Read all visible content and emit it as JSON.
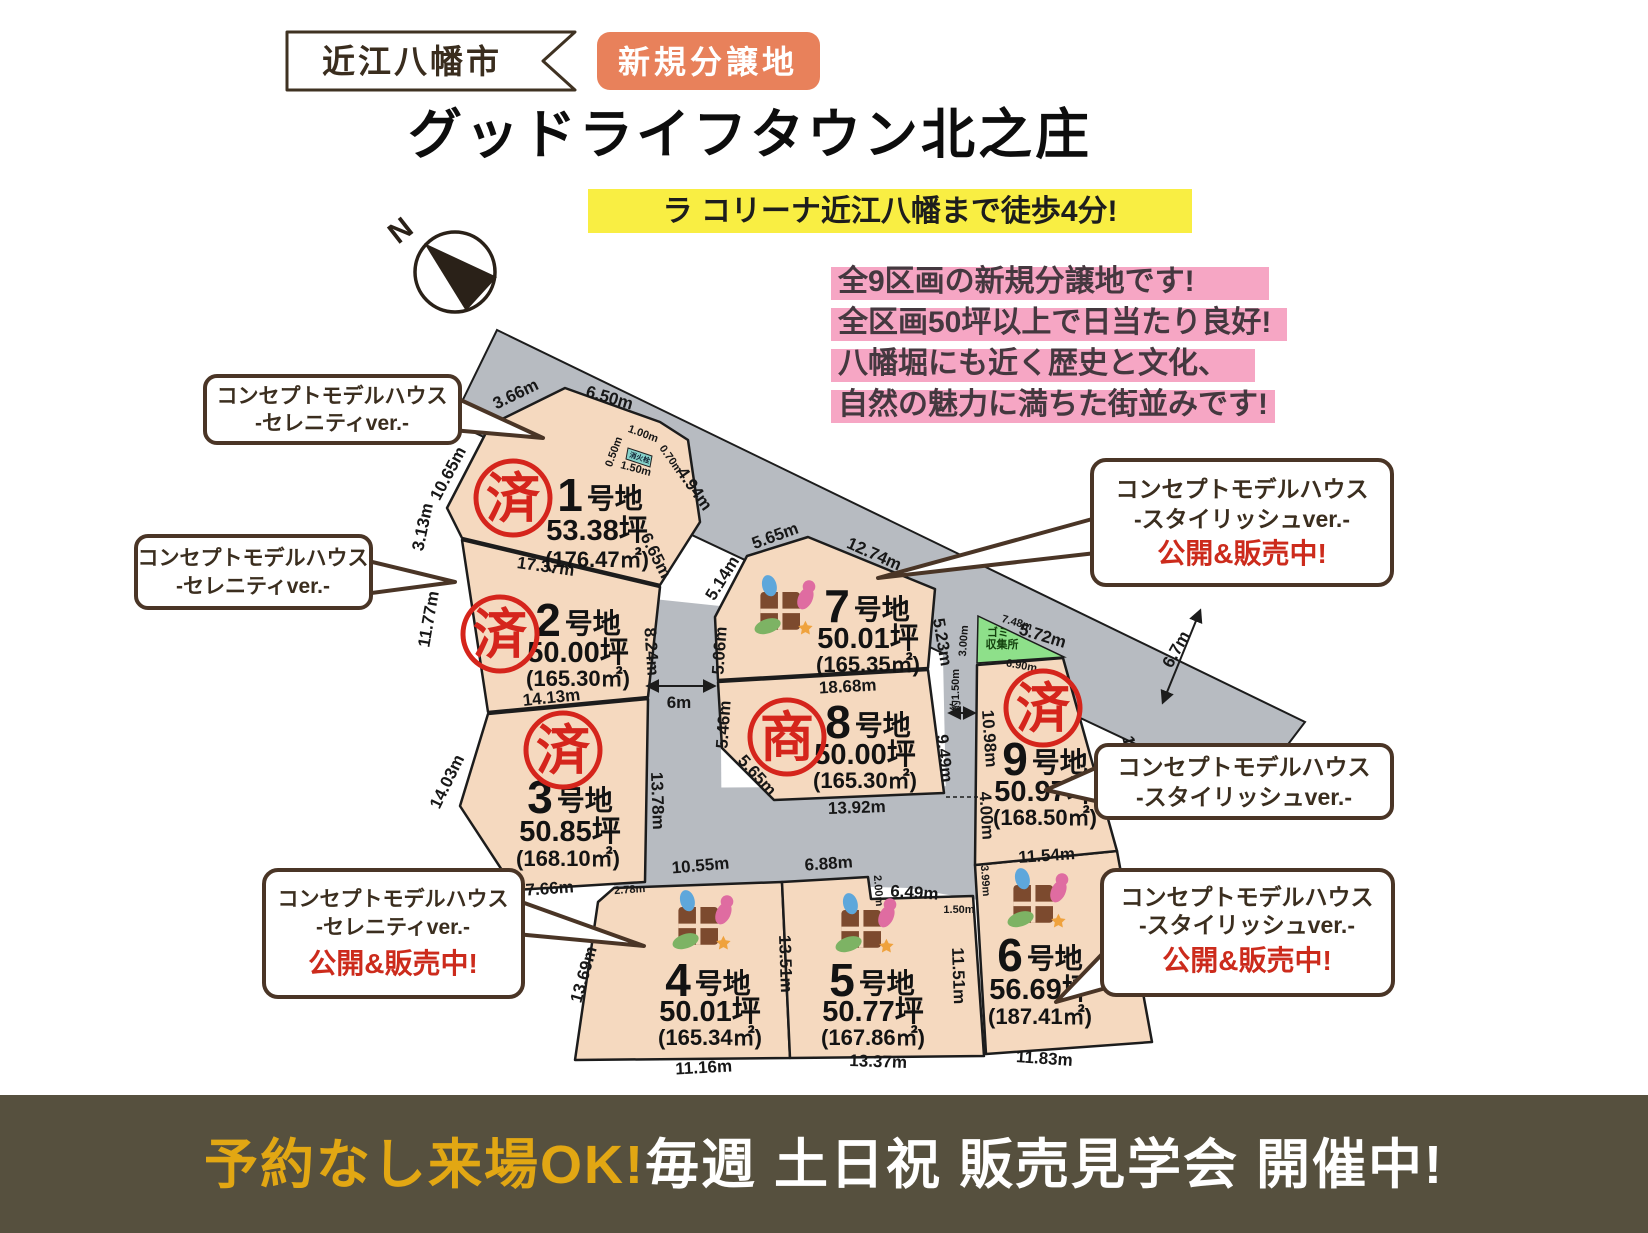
{
  "header": {
    "city_badge": "近江八幡市",
    "new_badge": "新規分譲地",
    "title": "グッドライフタウン北之庄",
    "highlight": "ラ コリーナ近江八幡まで徒歩4分!"
  },
  "features": [
    "全9区画の新規分譲地です!",
    "全区画50坪以上で日当たり良好!",
    "八幡堀にも近く歴史と文化、",
    "自然の魅力に満ちた街並みです!"
  ],
  "compass": {
    "label": "N"
  },
  "map": {
    "plot_suffix": "号地",
    "garbage_label1": "ゴミ",
    "garbage_label2": "収集所",
    "hydrant_label": "消火栓",
    "plots": [
      {
        "no": "1",
        "tsubo": "53.38坪",
        "sqm": "(176.47㎡)",
        "stamp": "済"
      },
      {
        "no": "2",
        "tsubo": "50.00坪",
        "sqm": "(165.30㎡)",
        "stamp": "済"
      },
      {
        "no": "3",
        "tsubo": "50.85坪",
        "sqm": "(168.10㎡)",
        "stamp": "済"
      },
      {
        "no": "4",
        "tsubo": "50.01坪",
        "sqm": "(165.34㎡)"
      },
      {
        "no": "5",
        "tsubo": "50.77坪",
        "sqm": "(167.86㎡)"
      },
      {
        "no": "6",
        "tsubo": "56.69坪",
        "sqm": "(187.41㎡)"
      },
      {
        "no": "7",
        "tsubo": "50.01坪",
        "sqm": "(165.35㎡)"
      },
      {
        "no": "8",
        "tsubo": "50.00坪",
        "sqm": "(165.30㎡)",
        "stamp": "商"
      },
      {
        "no": "9",
        "tsubo": "50.97坪",
        "sqm": "(168.50㎡)",
        "stamp": "済"
      }
    ],
    "measurements": [
      {
        "t": "3.66m",
        "x": 518,
        "y": 399,
        "r": -26
      },
      {
        "t": "6.50m",
        "x": 608,
        "y": 403,
        "r": 16
      },
      {
        "t": "10.65m",
        "x": 453,
        "y": 476,
        "r": -62
      },
      {
        "t": "3.13m",
        "x": 428,
        "y": 528,
        "r": -78
      },
      {
        "t": "17.37m",
        "x": 545,
        "y": 572,
        "r": 8
      },
      {
        "t": "4.94m",
        "x": 690,
        "y": 492,
        "r": 55
      },
      {
        "t": "6.65m",
        "x": 651,
        "y": 558,
        "r": 63
      },
      {
        "t": "1.00m",
        "x": 642,
        "y": 437,
        "r": 20,
        "s": 1
      },
      {
        "t": "0.70m",
        "x": 668,
        "y": 461,
        "r": 55,
        "s": 1
      },
      {
        "t": "1.50m",
        "x": 635,
        "y": 472,
        "r": 15,
        "s": 1
      },
      {
        "t": "0.50m",
        "x": 617,
        "y": 453,
        "r": -70,
        "s": 1
      },
      {
        "t": "11.77m",
        "x": 434,
        "y": 620,
        "r": -80
      },
      {
        "t": "8.24m",
        "x": 646,
        "y": 652,
        "r": 86
      },
      {
        "t": "14.13m",
        "x": 552,
        "y": 703,
        "r": -6
      },
      {
        "t": "14.03m",
        "x": 452,
        "y": 784,
        "r": -64
      },
      {
        "t": "13.78m",
        "x": 652,
        "y": 801,
        "r": 88
      },
      {
        "t": "7.66m",
        "x": 550,
        "y": 894,
        "r": -4
      },
      {
        "t": "6m",
        "x": 679,
        "y": 708,
        "r": 0
      },
      {
        "t": "5.65m",
        "x": 777,
        "y": 541,
        "r": -20
      },
      {
        "t": "12.74m",
        "x": 872,
        "y": 559,
        "r": 24
      },
      {
        "t": "5.14m",
        "x": 727,
        "y": 581,
        "r": -58
      },
      {
        "t": "5.06m",
        "x": 725,
        "y": 651,
        "r": -86
      },
      {
        "t": "5.23m",
        "x": 937,
        "y": 643,
        "r": 80
      },
      {
        "t": "18.68m",
        "x": 848,
        "y": 692,
        "r": -3
      },
      {
        "t": "5.46m",
        "x": 729,
        "y": 725,
        "r": -86
      },
      {
        "t": "5.65m",
        "x": 753,
        "y": 779,
        "r": 48
      },
      {
        "t": "9.49m",
        "x": 939,
        "y": 759,
        "r": 84
      },
      {
        "t": "13.92m",
        "x": 857,
        "y": 813,
        "r": -2
      },
      {
        "t": "約1.50m",
        "x": 959,
        "y": 690,
        "r": -90,
        "s": 1
      },
      {
        "t": "3.00m",
        "x": 967,
        "y": 641,
        "r": -86,
        "s": 1
      },
      {
        "t": "7.48m",
        "x": 1016,
        "y": 626,
        "r": 16,
        "s": 1
      },
      {
        "t": "5.72m",
        "x": 1041,
        "y": 641,
        "r": 17
      },
      {
        "t": "6.90m",
        "x": 1021,
        "y": 669,
        "r": 10,
        "s": 1
      },
      {
        "t": "6.7m",
        "x": 1181,
        "y": 652,
        "r": -61
      },
      {
        "t": "10.98m",
        "x": 984,
        "y": 739,
        "r": 86
      },
      {
        "t": "4.00m",
        "x": 981,
        "y": 816,
        "r": 86
      },
      {
        "t": "11.94m",
        "x": 1129,
        "y": 765,
        "r": 76
      },
      {
        "t": "11.54m",
        "x": 1047,
        "y": 861,
        "r": -4
      },
      {
        "t": "3.99m",
        "x": 982,
        "y": 881,
        "r": 86,
        "s": 1
      },
      {
        "t": "1.50m",
        "x": 959,
        "y": 913,
        "r": 0,
        "s": 1
      },
      {
        "t": "15.56m",
        "x": 1131,
        "y": 966,
        "r": 81
      },
      {
        "t": "11.83m",
        "x": 1044,
        "y": 1064,
        "r": 4
      },
      {
        "t": "6.88m",
        "x": 829,
        "y": 869,
        "r": -4
      },
      {
        "t": "2.00m",
        "x": 875,
        "y": 891,
        "r": 86,
        "s": 1
      },
      {
        "t": "6.49m",
        "x": 914,
        "y": 898,
        "r": 4
      },
      {
        "t": "11.51m",
        "x": 953,
        "y": 976,
        "r": 88
      },
      {
        "t": "13.37m",
        "x": 878,
        "y": 1067,
        "r": 2
      },
      {
        "t": "10.55m",
        "x": 701,
        "y": 871,
        "r": -5
      },
      {
        "t": "2.78m",
        "x": 630,
        "y": 893,
        "r": -4,
        "s": 1
      },
      {
        "t": "13.69m",
        "x": 589,
        "y": 976,
        "r": -74
      },
      {
        "t": "13.51m",
        "x": 780,
        "y": 964,
        "r": 88
      },
      {
        "t": "11.16m",
        "x": 704,
        "y": 1073,
        "r": -3
      }
    ]
  },
  "callouts": [
    {
      "lines": [
        "コンセプトモデルハウス",
        "-セレニティver.-"
      ]
    },
    {
      "lines": [
        "コンセプトモデルハウス",
        "-セレニティver.-"
      ]
    },
    {
      "lines": [
        "コンセプトモデルハウス",
        "-スタイリッシュver.-"
      ],
      "status": "公開&販売中!"
    },
    {
      "lines": [
        "コンセプトモデルハウス",
        "-スタイリッシュver.-"
      ]
    },
    {
      "lines": [
        "コンセプトモデルハウス",
        "-セレニティver.-"
      ],
      "status": "公開&販売中!"
    },
    {
      "lines": [
        "コンセプトモデルハウス",
        "-スタイリッシュver.-"
      ],
      "status": "公開&販売中!"
    }
  ],
  "footer": {
    "highlight": "予約なし来場OK!",
    "main": "毎週 土日祝 販売見学会 開催中!"
  },
  "colors": {
    "road": "#b7bbc1",
    "plot": "#f5d9bf",
    "stamp_red": "#d5251c",
    "badge_orange": "#e8815b",
    "highlight_yellow": "#f9ee43",
    "highlight_pink": "#f6a6c4",
    "footer_bg": "#56503e",
    "footer_yellow": "#e2a713",
    "callout_brown": "#4a3526"
  }
}
